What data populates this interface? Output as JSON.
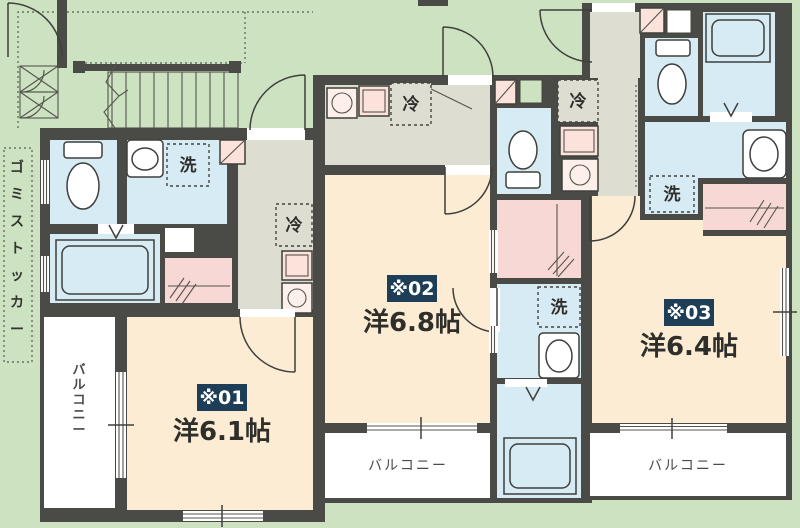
{
  "plan": {
    "units": [
      {
        "no": "※01",
        "size": "洋6.1帖"
      },
      {
        "no": "※02",
        "size": "洋6.8帖"
      },
      {
        "no": "※03",
        "size": "洋6.4帖"
      }
    ],
    "fixtures": {
      "washer": "洗",
      "fridge": "冷"
    },
    "balcony": "バルコニー",
    "garbage_stocker": "ゴミストッカー"
  },
  "colors": {
    "exterior": "#cde2c1",
    "room": "#fcecd4",
    "water": "#d6ebf3",
    "hall": "#deddd2",
    "closet": "#f8d8d4",
    "sink": "#fbe2da",
    "wall": "#4a4a46",
    "badge": "#1e3d57"
  }
}
